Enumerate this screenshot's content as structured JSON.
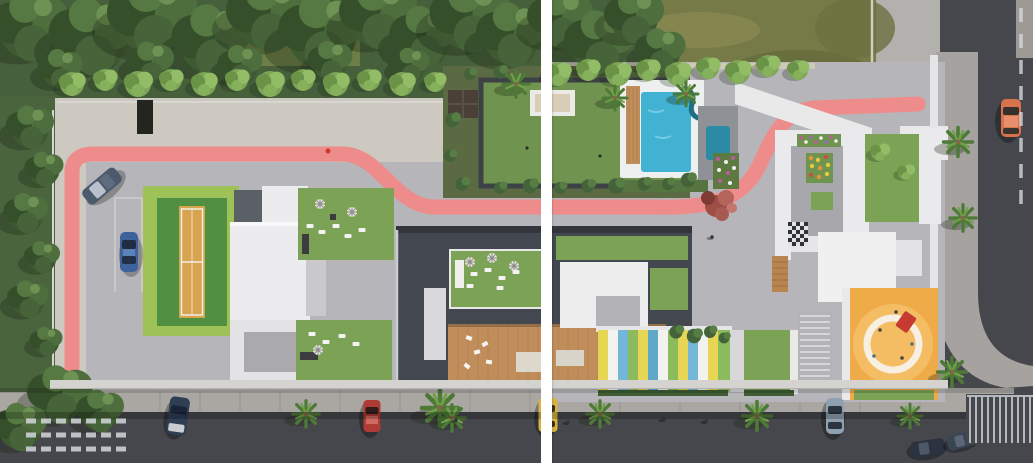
{
  "scene": {
    "description": "Aerial 3D architectural rendering of a residential complex site plan, split into two panels by a white vertical seam line",
    "colors": {
      "canopy_dark": "#46603b",
      "tree_light": "#7da557",
      "field_olive": "#757a46",
      "lawn_green": "#70944f",
      "roof_green": "#7ca256",
      "track_pink": "#ee8c8c",
      "paving_warm": "#cdc9c1",
      "paving_gray": "#b6b5b9",
      "pavement_right": "#b6b5b9",
      "roof_white": "#ececee",
      "roof_dark": "#43474f",
      "asphalt": "#46474c",
      "sidewalk": "#aaa7a3",
      "pool_water": "#41b2d2",
      "pool_kids": "#2c8ba4",
      "wood_deck": "#c08d5b",
      "court_green": "#4f9140",
      "court_clay": "#d9a44f",
      "playground_orange": "#f0ab49",
      "divider_white": "#ffffff",
      "crosswalk_white": "#ccd0d3"
    },
    "kids_stripe_palette": [
      "#e6d654",
      "#f2f2ee",
      "#74b6d8",
      "#8cbb5e",
      "#5fa8c8"
    ],
    "cars": [
      {
        "name": "sedan-diagonal-courtyard",
        "color": "#4d5a6e",
        "location": "left courtyard, parked diagonally"
      },
      {
        "name": "sedan-blue-courtyard",
        "color": "#3e639c",
        "location": "left courtyard parking bay"
      },
      {
        "name": "car-orange-right-street",
        "color": "#d9734e",
        "location": "right vertical street"
      },
      {
        "name": "sedan-dark-bottom-left",
        "color": "#2f3d55",
        "location": "bottom street, left"
      },
      {
        "name": "car-red-bottom",
        "color": "#b03a35",
        "location": "bottom street, parked"
      },
      {
        "name": "taxi-yellow-bottom",
        "color": "#d9b33c",
        "location": "bottom street, under seam line"
      },
      {
        "name": "car-silver-bottom",
        "color": "#8fa0b0",
        "location": "bottom street, parked right"
      },
      {
        "name": "car-moving-a",
        "color": "#2b3340",
        "location": "bottom right, driving"
      },
      {
        "name": "car-moving-b",
        "color": "#3a4554",
        "location": "bottom right, driving"
      }
    ],
    "amenities": [
      "jogging-track",
      "sports-court",
      "swimming-pool",
      "kids-pool",
      "water-slide",
      "garden-lawn",
      "pergola-daybed",
      "gazebo",
      "rooftop-gardens",
      "wooden-deck-terrace",
      "kids-play-stripes",
      "circular-playground",
      "checkerboard-terrace",
      "flower-beds",
      "stairway",
      "parking-bays",
      "crosswalk"
    ],
    "vegetation": {
      "top_tree_belt": "dense dark green canopy, upper left",
      "grass_field": "olive meadow, upper right",
      "palm_trees_bottom_sidewalk": 5,
      "palm_trees_right_sidewalk": 3,
      "street_tree_rows": "small round trees along walls"
    }
  }
}
